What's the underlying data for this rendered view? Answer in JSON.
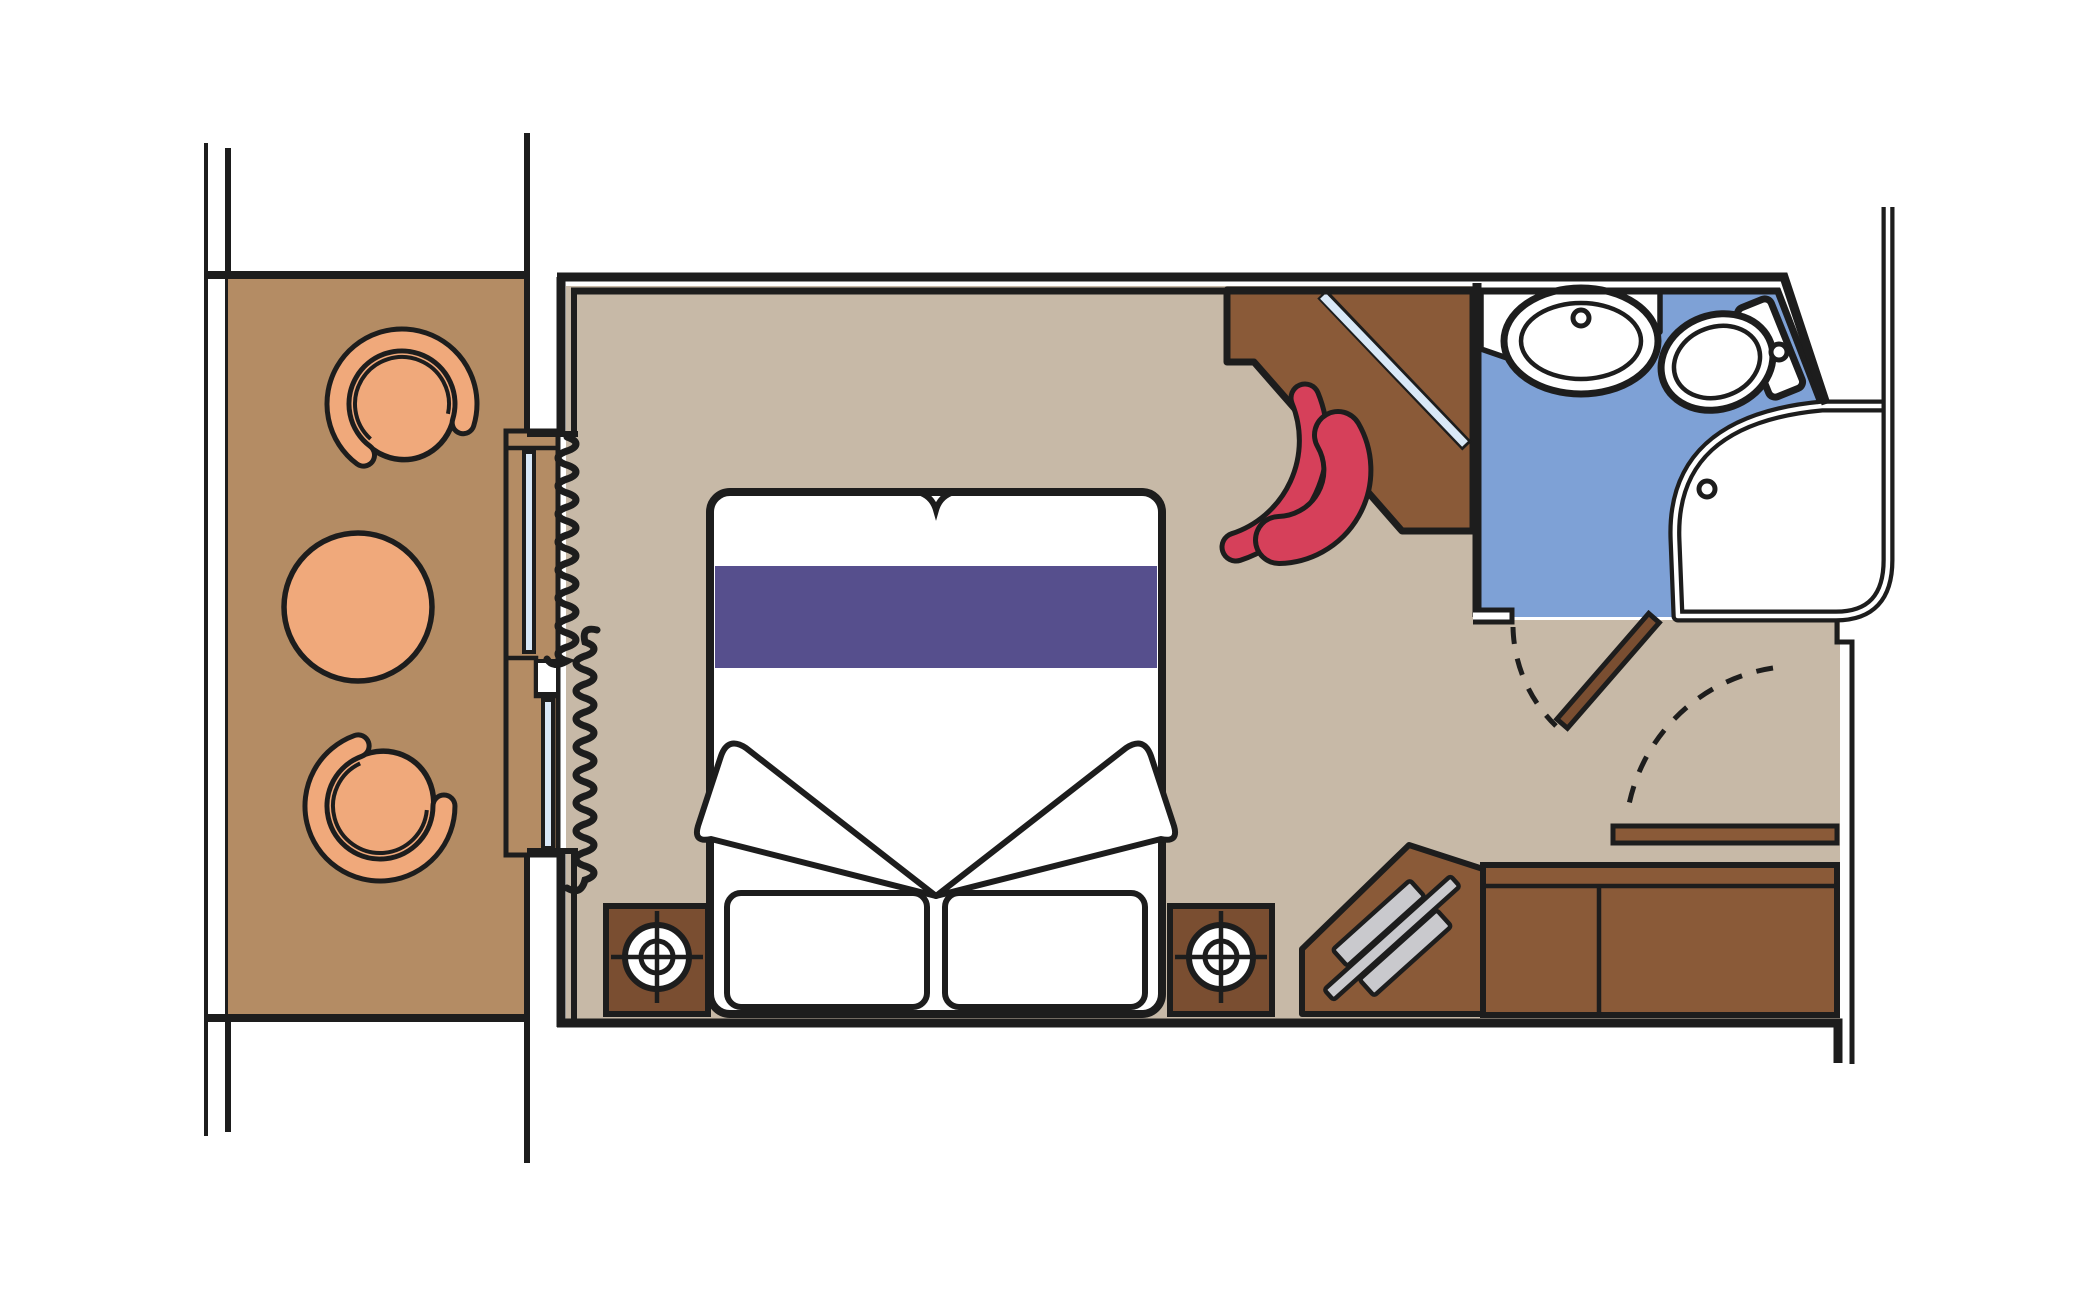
{
  "plan": {
    "type": "cruise-cabin-floor-plan",
    "rooms": [
      {
        "id": "balcony",
        "label": "Balcony",
        "furniture": [
          "tub-chair",
          "round-table",
          "tub-chair"
        ]
      },
      {
        "id": "cabin",
        "label": "Cabin",
        "furniture": [
          "sliding-glass-door",
          "curtains",
          "double-bed",
          "pillows",
          "blanket-folds",
          "nightstand-with-lamp",
          "nightstand-with-lamp",
          "corner-desk-with-mirror",
          "desk-chair",
          "luggage-bench",
          "wardrobe",
          "entry-door"
        ]
      },
      {
        "id": "bathroom",
        "label": "Bathroom",
        "furniture": [
          "counter",
          "sink",
          "toilet",
          "shower",
          "bathroom-door"
        ]
      }
    ]
  },
  "colors": {
    "outline": "#1d1d1d",
    "white": "#ffffff",
    "balcony_floor": "#b48c64",
    "cabin_floor": "#c7b9a7",
    "bathroom_floor": "#7ea1d6",
    "furniture_peach": "#f0a97b",
    "wood_brown": "#8a5a38",
    "wood_dark": "#7a4e31",
    "bed_runner_purple": "#564f8d",
    "chair_red": "#d6405a",
    "glass_blue": "#d9e8f7",
    "metal_gray": "#c9c9cd"
  }
}
